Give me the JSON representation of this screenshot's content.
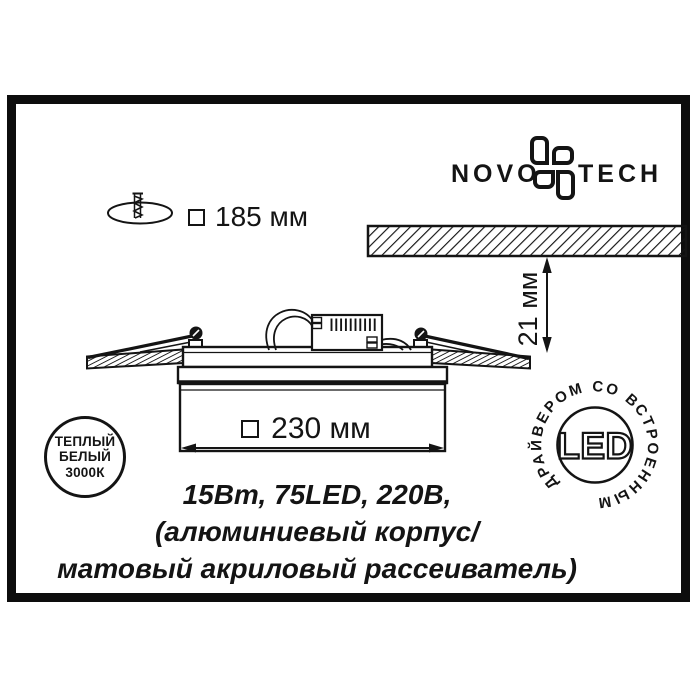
{
  "colors": {
    "ink": "#141414",
    "background": "#ffffff"
  },
  "logo": {
    "word_left": "NOVO",
    "word_right": "TECH"
  },
  "cutout_dimension": {
    "symbol": "square",
    "value": "185 мм"
  },
  "recess_depth_dimension": {
    "value": "21 мм"
  },
  "body_width_dimension": {
    "symbol": "square",
    "value": "230 мм"
  },
  "warm_white_badge": {
    "line1": "ТЕПЛЫЙ",
    "line2": "БЕЛЫЙ",
    "line3": "3000К"
  },
  "led_badge": {
    "center": "LED",
    "ring_text": "ДРАЙВЕРОМ СО ВСТРОЕННЫМ"
  },
  "specs": {
    "line1": "15Вт, 75LED, 220В,",
    "line2": "(алюминиевый корпус/",
    "line3": "матовый акриловый рассеиватель)"
  }
}
